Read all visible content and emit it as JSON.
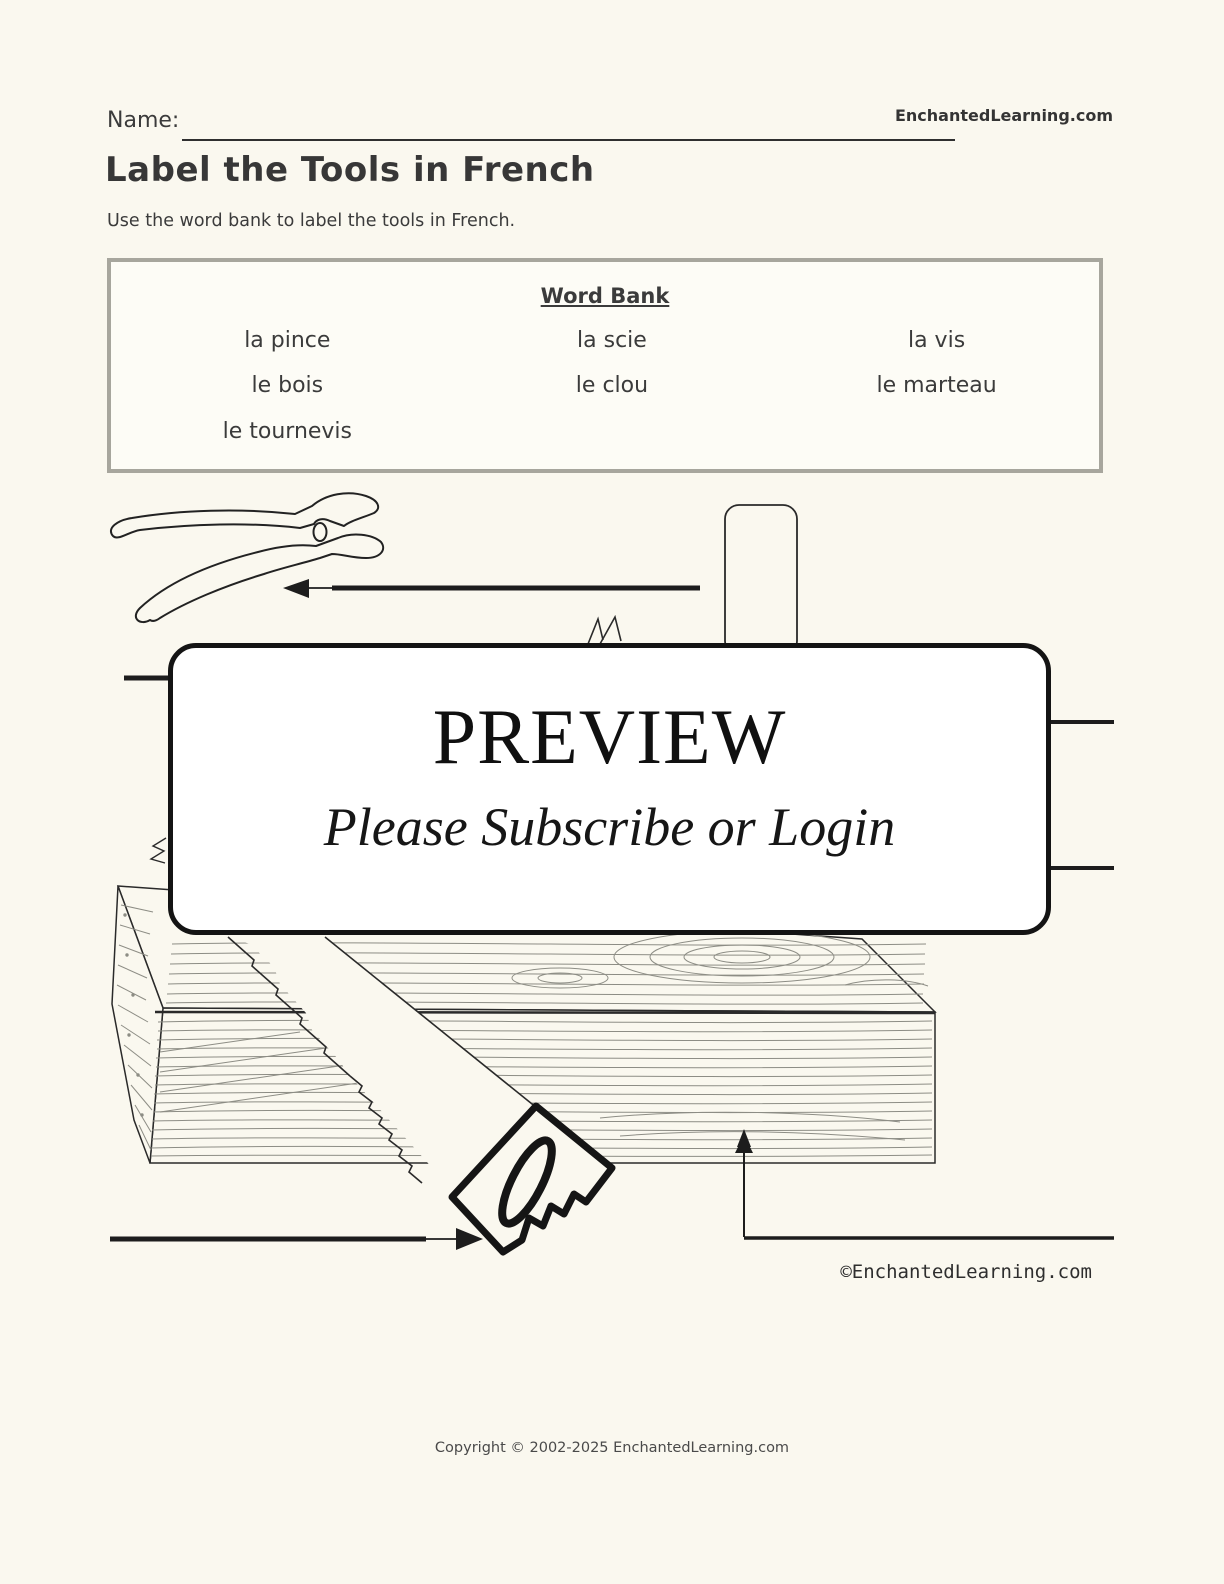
{
  "page": {
    "name_label": "Name:",
    "site": "EnchantedLearning.com",
    "title": "Label the Tools in French",
    "instructions": "Use the word bank to label the tools in French.",
    "drawing_credit": "©EnchantedLearning.com",
    "footer_copyright": "Copyright © 2002-2025 EnchantedLearning.com"
  },
  "word_bank": {
    "title": "Word Bank",
    "words": [
      "la pince",
      "la scie",
      "la vis",
      "le bois",
      "le clou",
      "le marteau",
      "le tournevis"
    ]
  },
  "preview": {
    "title": "PREVIEW",
    "subtitle": "Please Subscribe or Login"
  },
  "drawing": {
    "tools_depicted": [
      "pliers",
      "hammer handle",
      "screw tips",
      "screwdriver tip",
      "wood plank",
      "saw",
      "nail"
    ],
    "answer_lines": 7
  },
  "icons": {
    "pliers-icon": "line-art pliers",
    "hammer-icon": "line-art hammer handle",
    "saw-icon": "line-art handsaw cutting wood",
    "wood-icon": "line-art lumber plank with grain",
    "nail-icon": "small nail head in wood",
    "arrow-left-icon": "◀",
    "arrow-right-icon": "▶"
  },
  "colors": {
    "page_bg": "#faf8ef",
    "ink": "#222222",
    "grain": "#8d8d85",
    "box_border": "#a7a69d",
    "text": "#3b3b3b",
    "preview_bg": "#ffffff"
  }
}
